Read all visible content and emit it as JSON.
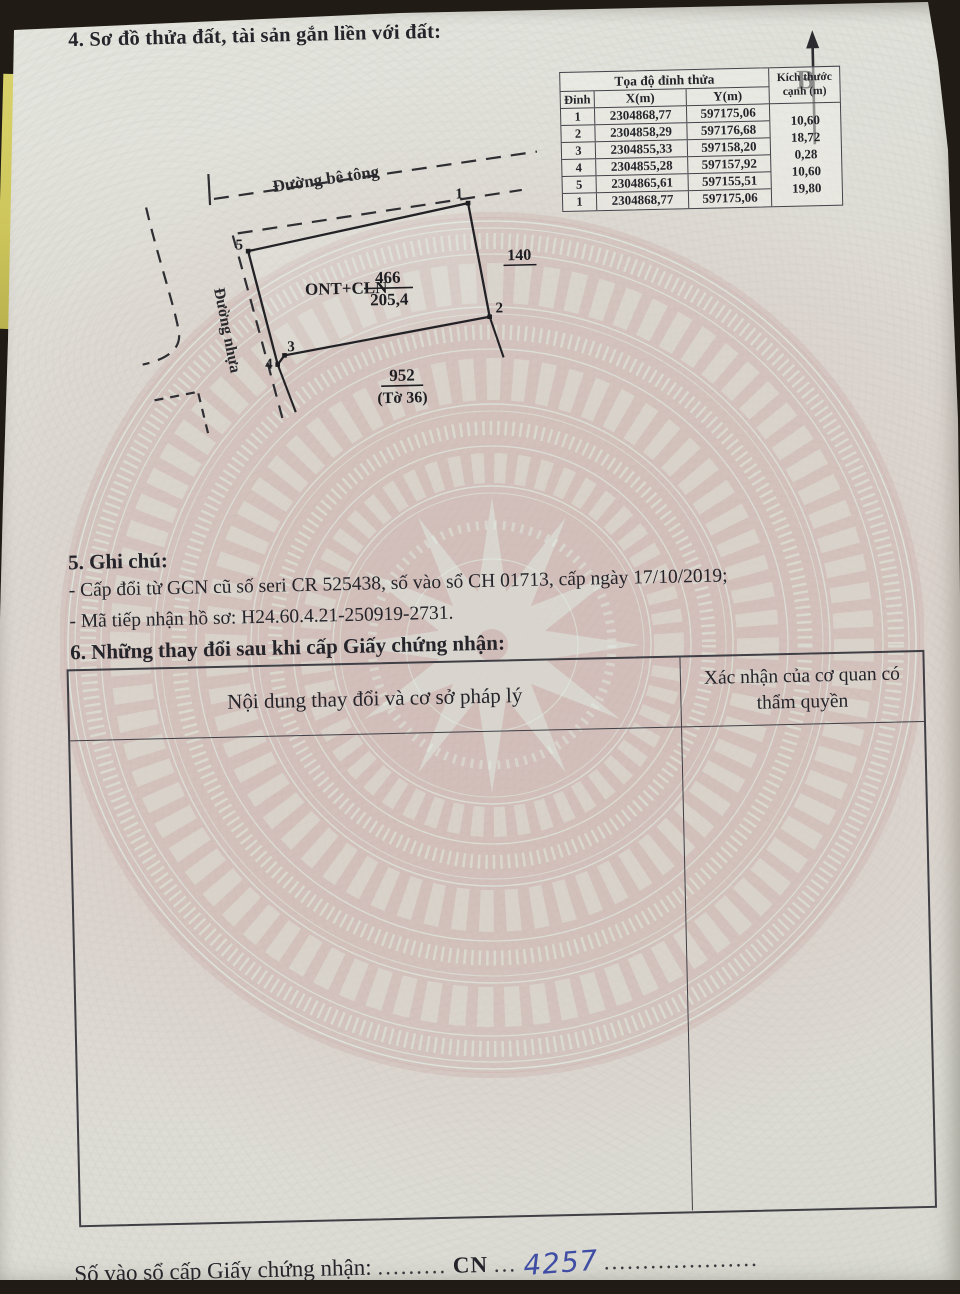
{
  "page": {
    "section4_title": "4. Sơ đồ thửa đất, tài sản gắn liền với đất:",
    "section5_title": "5. Ghi chú:",
    "section5_line1": "- Cấp đổi từ GCN cũ số seri CR 525438, số vào sổ CH 01713, cấp  ngày 17/10/2019;",
    "section5_line2": "- Mã tiếp nhận hồ sơ: H24.60.4.21-250919-2731.",
    "section6_title": "6. Những thay đổi sau khi cấp Giấy chứng nhận:"
  },
  "coord_table": {
    "header_group": "Tọa độ đỉnh thửa",
    "col_vertex": "Đỉnh",
    "col_x": "X(m)",
    "col_y": "Y(m)",
    "col_edge_line1": "Kích thước",
    "col_edge_line2": "cạnh (m)",
    "rows": [
      {
        "v": "1",
        "x": "2304868,77",
        "y": "597175,06"
      },
      {
        "v": "2",
        "x": "2304858,29",
        "y": "597176,68"
      },
      {
        "v": "3",
        "x": "2304855,33",
        "y": "597158,20"
      },
      {
        "v": "4",
        "x": "2304855,28",
        "y": "597157,92"
      },
      {
        "v": "5",
        "x": "2304865,61",
        "y": "597155,51"
      },
      {
        "v": "1",
        "x": "2304868,77",
        "y": "597175,06"
      }
    ],
    "edges": [
      "10,60",
      "18,72",
      "0,28",
      "10,60",
      "19,80"
    ]
  },
  "diagram": {
    "north_label": "B",
    "road_top": "Đường bê tông",
    "road_left": "Đường nhựa",
    "plot_use": "ONT+CLN",
    "plot_number": "466",
    "plot_area": "205,4",
    "adjacent_right": "140",
    "adjacent_bottom": "952",
    "adjacent_bottom_sheet": "(Tờ 36)",
    "v1": "1",
    "v2": "2",
    "v3": "3",
    "v4": "4",
    "v5": "5"
  },
  "change_table": {
    "col_content": "Nội dung thay đổi và cơ sở pháp lý",
    "col_confirm": "Xác nhận của cơ quan có thẩm quyền"
  },
  "footer": {
    "label": "Số vào sổ cấp Giấy chứng nhận:",
    "dots_before": ".........",
    "serial_prefix": "CN",
    "dots_mid": "...",
    "serial_number": "4257",
    "dots_after": "...................."
  },
  "colors": {
    "paper": "#dfe0d9",
    "drum_pink": "#c9a8a5",
    "drum_mint": "#dcebe0",
    "ink": "#24242a",
    "handwriting_blue": "#3f4da4",
    "backing_yellow": "#d8d169"
  }
}
